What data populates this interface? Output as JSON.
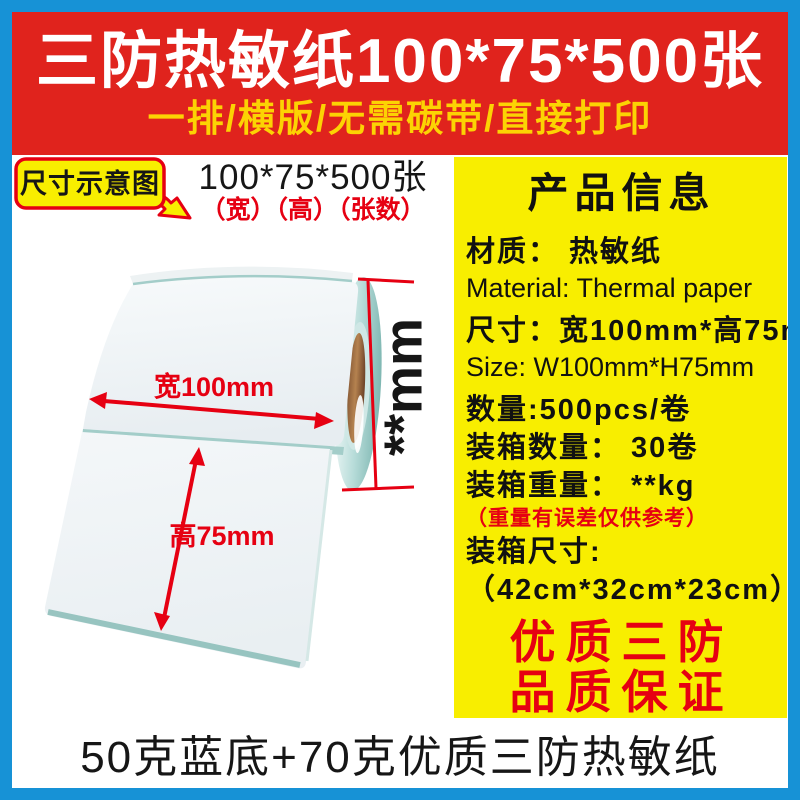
{
  "banner": {
    "title": "三防热敏纸100*75*500张",
    "subtitle": "一排/横版/无需碳带/直接打印"
  },
  "size_callout": {
    "bubble_label": "尺寸示意图",
    "spec": "100*75*500张",
    "spec_note": "（宽）（高）（张数）"
  },
  "diagram": {
    "width_label": "宽100mm",
    "height_label": "高75mm",
    "thickness_label": "**mm"
  },
  "info_panel": {
    "title": "产品信息",
    "rows": [
      {
        "text": "材质： 热敏纸",
        "style": "cn"
      },
      {
        "text": "Material: Thermal paper",
        "style": "en"
      },
      {
        "text": "尺寸：宽100mm*高75mm",
        "style": "cn"
      },
      {
        "text": "Size: W100mm*H75mm",
        "style": "en"
      },
      {
        "text": "数量:500pcs/卷",
        "style": "cn"
      },
      {
        "text": "装箱数量： 30卷",
        "style": "cn"
      },
      {
        "text": "装箱重量： **kg",
        "style": "cn"
      },
      {
        "text": "（重量有误差仅供参考）",
        "style": "note"
      },
      {
        "text": "装箱尺寸:",
        "style": "cn"
      },
      {
        "text": "（42cm*32cm*23cm）",
        "style": "cn"
      }
    ],
    "badge_line1": "优质三防",
    "badge_line2": "品质保证"
  },
  "footer": {
    "text": "50克蓝底+70克优质三防热敏纸"
  },
  "colors": {
    "frame_blue": "#1792d6",
    "banner_red": "#e0231d",
    "panel_yellow": "#f8ee00",
    "subtitle_gold": "#fcd303",
    "accent_red": "#e60012",
    "text_black": "#161616",
    "liner_teal": "#a3cdc9",
    "core_brown": "#9c6a40"
  }
}
